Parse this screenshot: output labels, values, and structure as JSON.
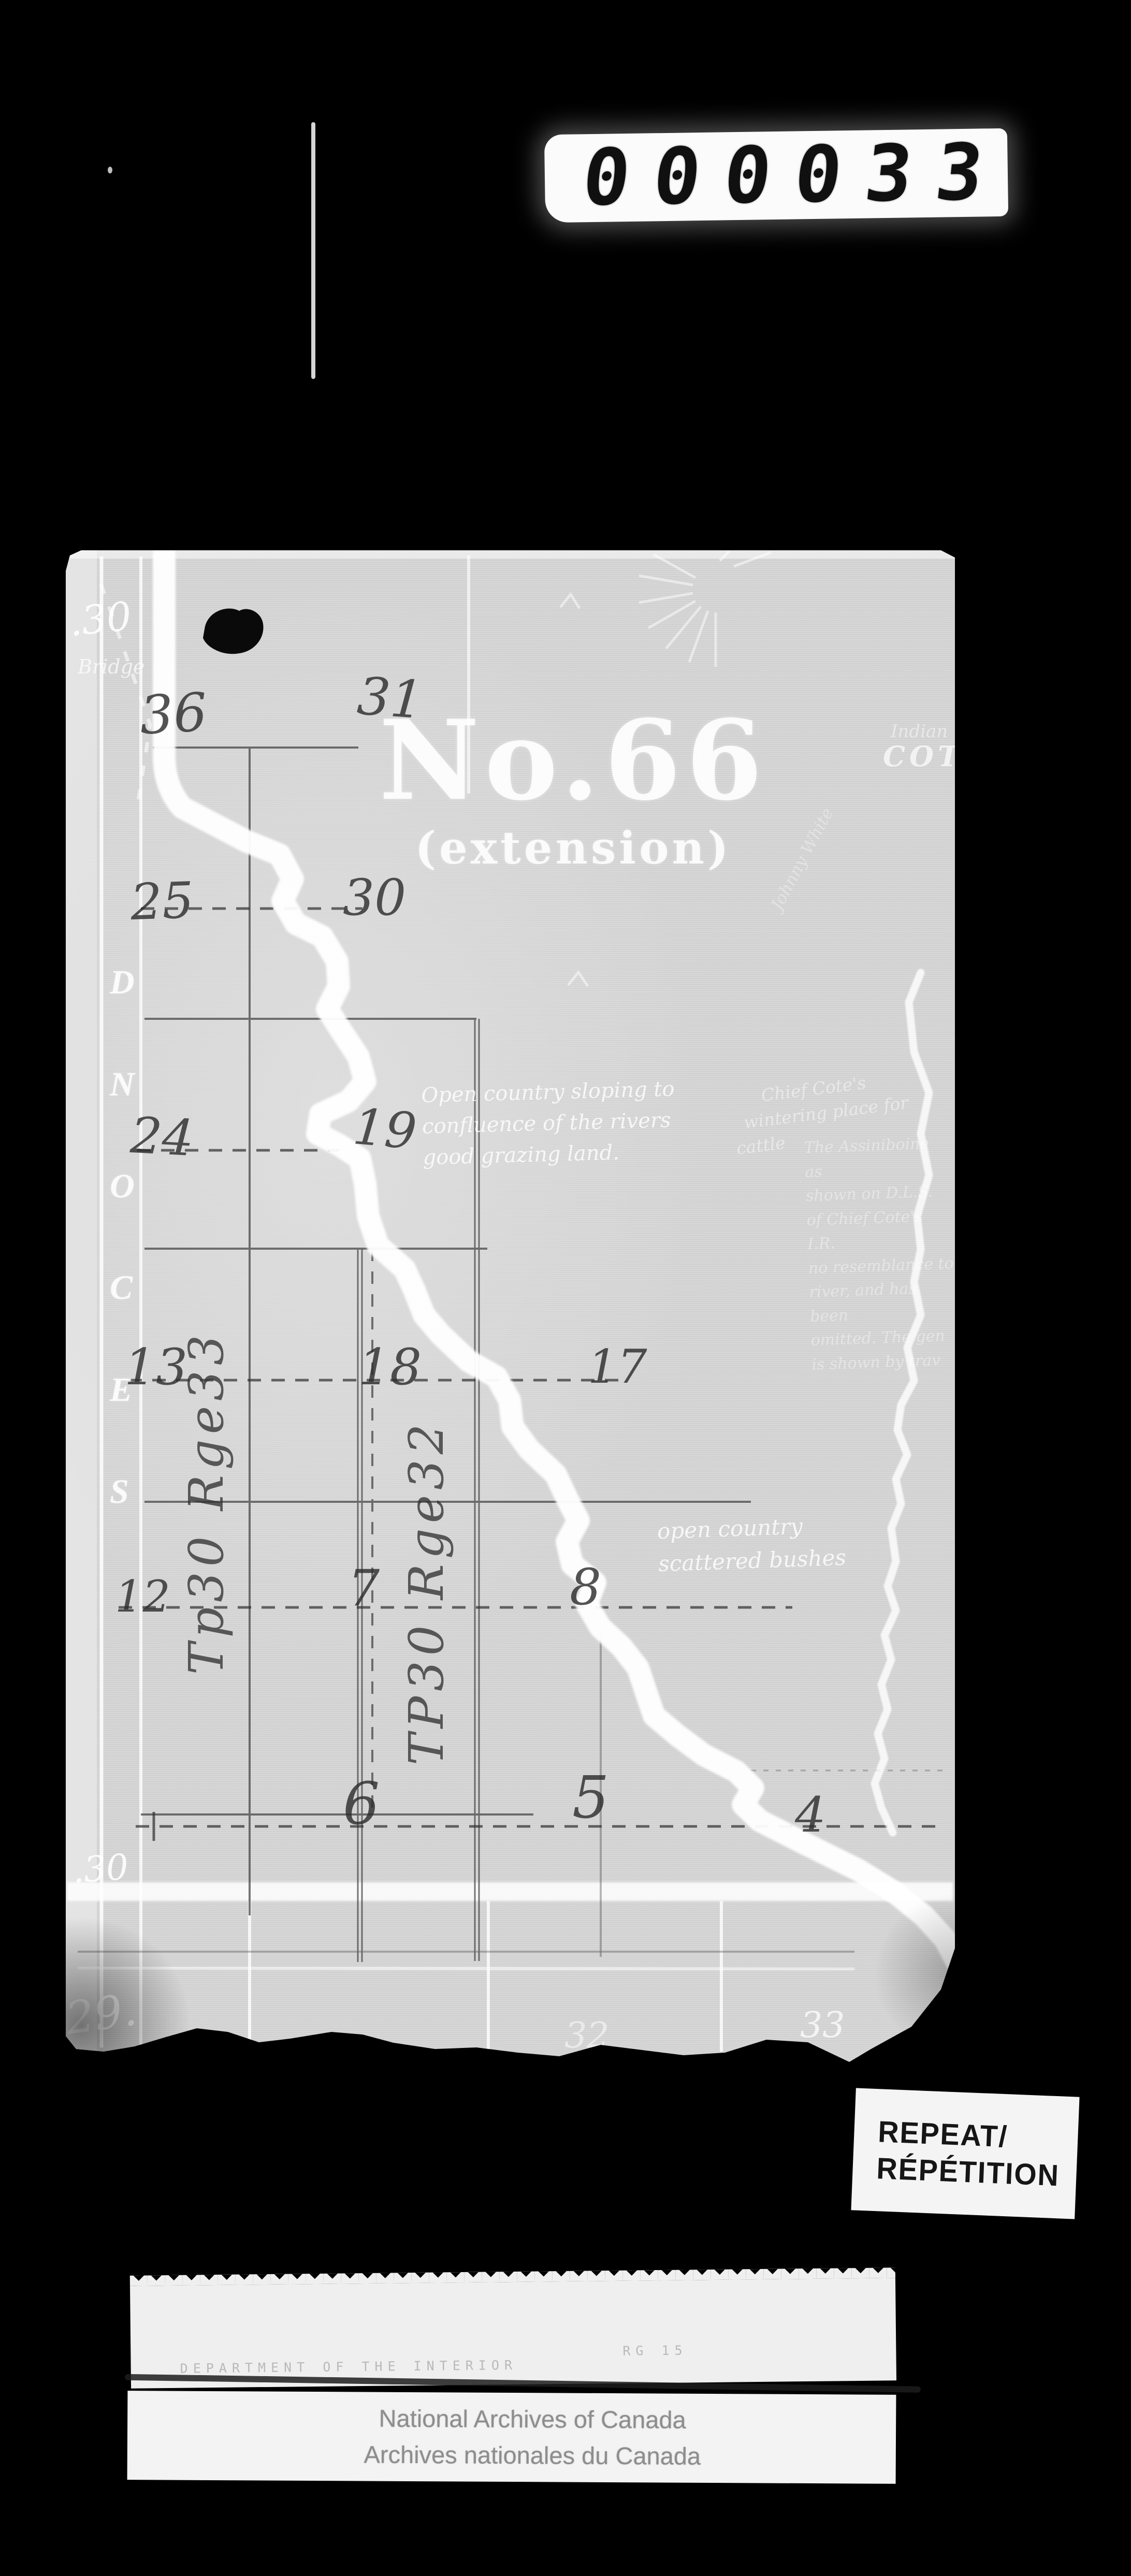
{
  "colors": {
    "background": "#000000",
    "paper": "#d7d7d7",
    "pencil": "#3b3b3b",
    "map_ink": "#ffffff"
  },
  "film": {
    "counter_value": "000033"
  },
  "map": {
    "title": "No.66",
    "subtitle": "(extension)",
    "meridian_label": "SECOND",
    "printed": {
      "top_left_number": ".30",
      "bridge": "Bridge",
      "indian": "Indian",
      "cote": "COTE",
      "left_number": ".30",
      "bottom_left_number": "29.",
      "bottom_number_a": "32",
      "bottom_number_b": "33"
    },
    "annotations": {
      "open_country": [
        "Open country sloping to",
        "confluence of the rivers",
        "good grazing land."
      ],
      "chief_cote": [
        "Chief Cote's",
        "wintering place for",
        "cattle"
      ],
      "assiniboine_note": [
        "The Assiniboine as",
        "shown on D.L.S.",
        "of Chief Cote's I.R.",
        "no resemblance to",
        "river, and has been",
        "omitted. The gen",
        "is shown by trav"
      ],
      "scattered": [
        "open country",
        "scattered bushes"
      ],
      "name_scribble": "Johnny White"
    },
    "sections": {
      "row1": [
        "36",
        "31"
      ],
      "row2": [
        "25",
        "30"
      ],
      "row3": [
        "24",
        "19"
      ],
      "row4": [
        "13",
        "18",
        "17"
      ],
      "row5": [
        "12",
        "7",
        "8"
      ],
      "row6": [
        "6",
        "5",
        "4"
      ]
    },
    "township_labels": {
      "left": "Tp30 Rge33",
      "middle": "TP30 Rge32"
    }
  },
  "stamp": {
    "line1": "REPEAT/",
    "line2": "RÉPÉTITION"
  },
  "target_card": {
    "dept_en": "DEPARTMENT OF THE INTERIOR",
    "dept_fr": "MINISTÈRE DE L'INTÉRIEUR",
    "ref1": "RG 15",
    "ref2": "File",
    "ref3": "11 1"
  },
  "footer": {
    "en": "National Archives of Canada",
    "fr": "Archives nationales du Canada"
  }
}
